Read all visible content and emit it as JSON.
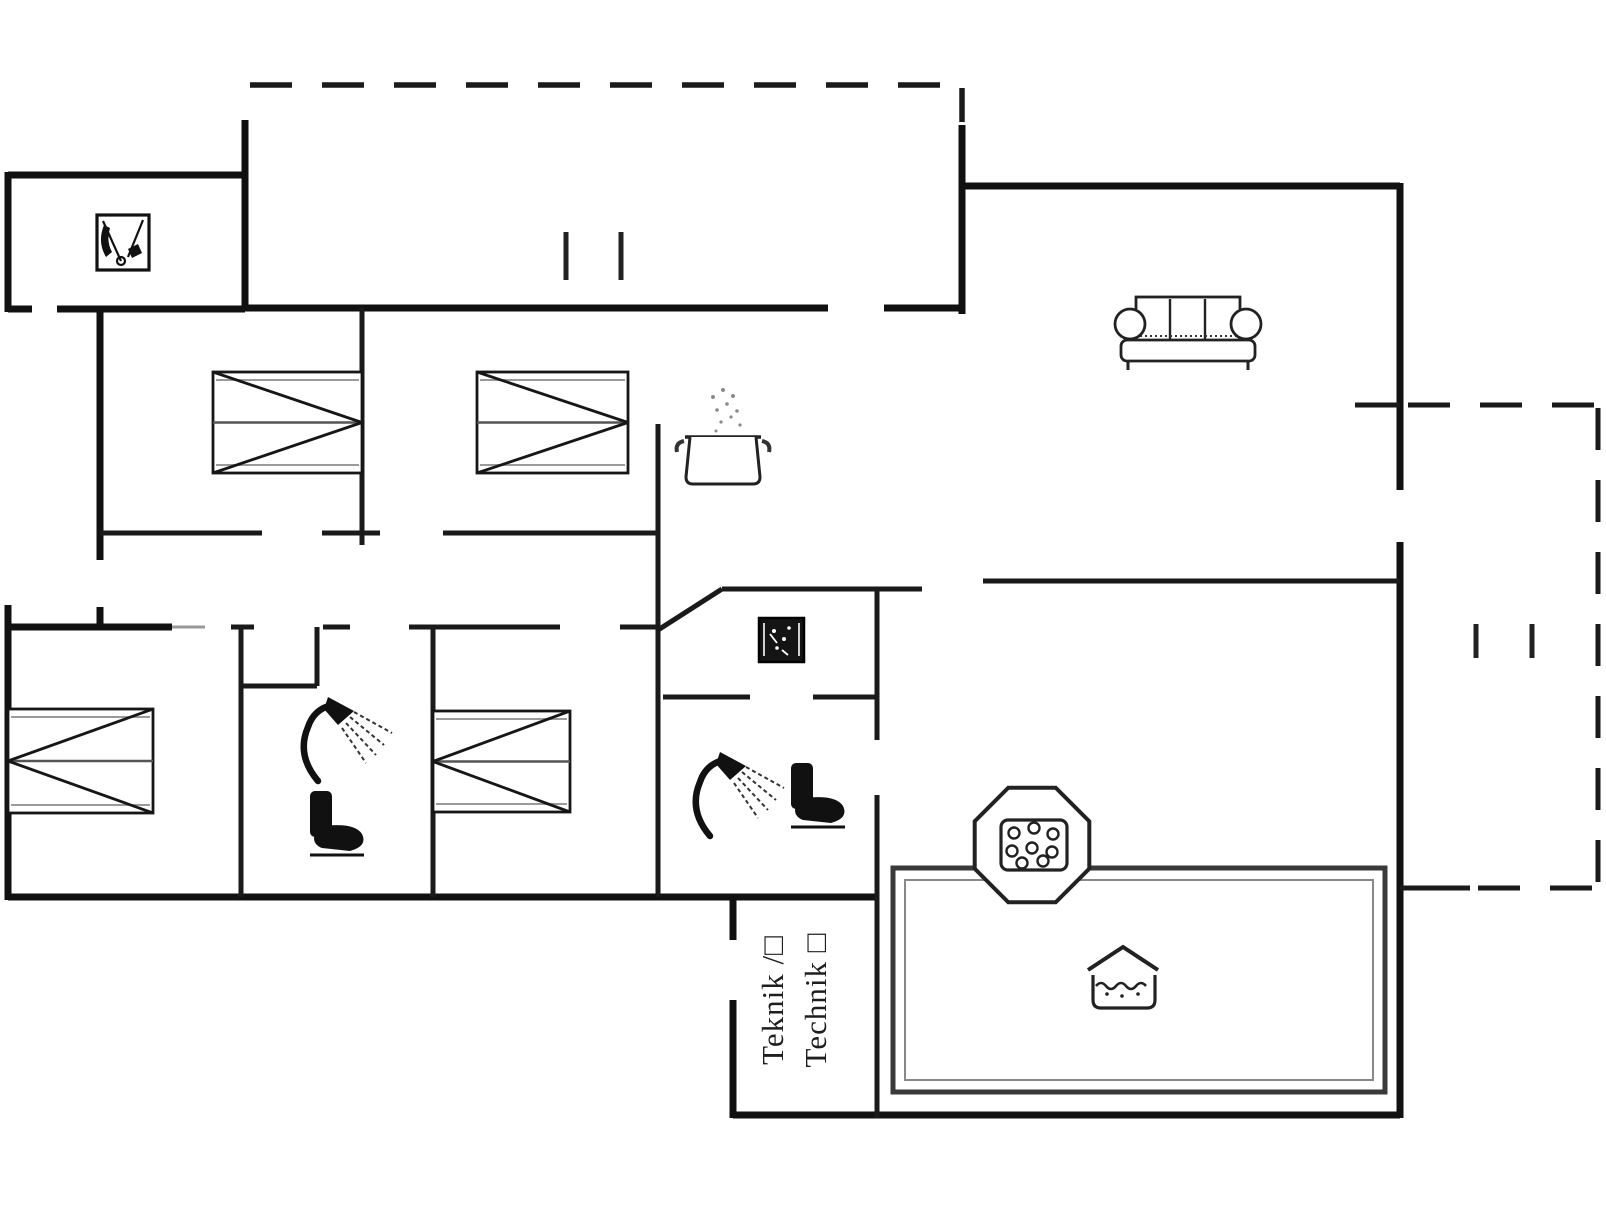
{
  "page": {
    "type": "house-floor-plan",
    "background": "#ffffff"
  },
  "labels": {
    "technical_room_da": "Teknik /□",
    "technical_room_de": "Technik □"
  },
  "colors": {
    "wall": "#111111",
    "inner_wall": "#1a1a1a",
    "bed_gray": "#9a9a9a",
    "pool_inner": "#888888",
    "background": "#ffffff"
  },
  "icons": [
    "washbasin-icon",
    "double-bed-icon",
    "double-bed-icon",
    "cooking-pot-icon",
    "sofa-icon",
    "double-bed-icon",
    "shower-icon",
    "toilet-icon",
    "double-bed-icon",
    "wood-stove-icon",
    "shower-icon",
    "toilet-icon",
    "hot-tub-icon",
    "swimming-pool-icon",
    "terrace-dashed-outline",
    "window-marks"
  ]
}
